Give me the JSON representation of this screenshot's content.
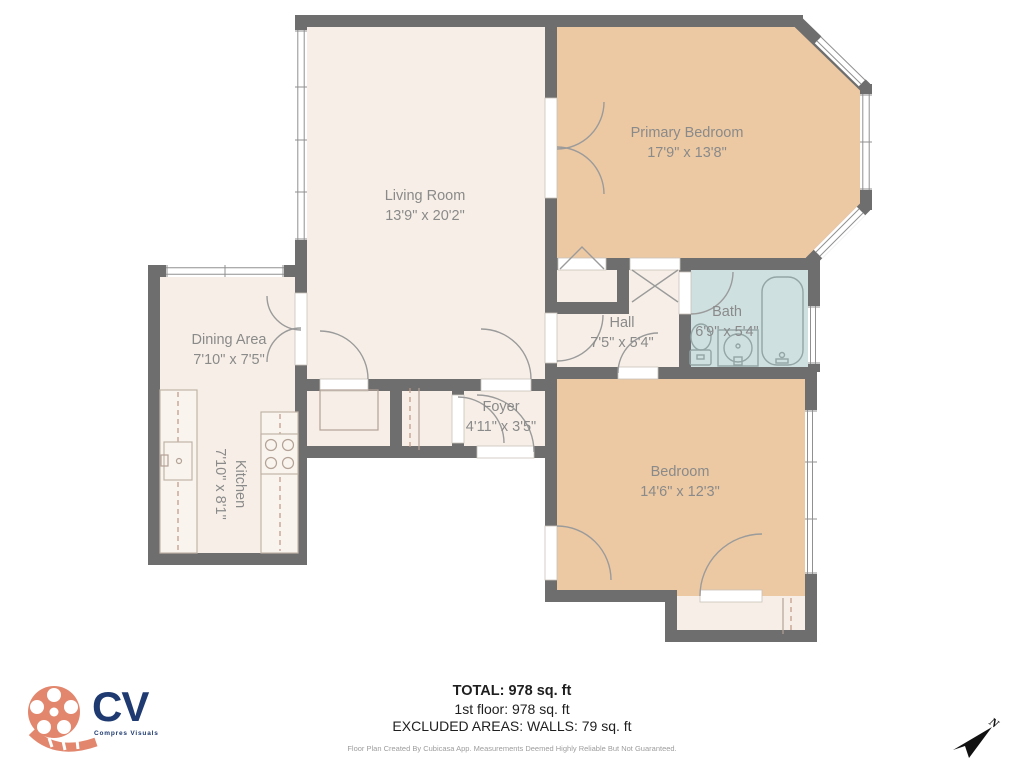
{
  "rooms": {
    "living_room": {
      "name": "Living Room",
      "dims": "13'9\" x 20'2\""
    },
    "primary_bedroom": {
      "name": "Primary Bedroom",
      "dims": "17'9\" x 13'8\""
    },
    "dining_area": {
      "name": "Dining Area",
      "dims": "7'10\" x 7'5\""
    },
    "kitchen": {
      "name": "Kitchen",
      "dims": "7'10\" x 8'1\""
    },
    "hall": {
      "name": "Hall",
      "dims": "7'5\" x 5'4\""
    },
    "bath": {
      "name": "Bath",
      "dims": "6'9\" x 5'4\""
    },
    "foyer": {
      "name": "Foyer",
      "dims": "4'11\" x 3'5\""
    },
    "bedroom": {
      "name": "Bedroom",
      "dims": "14'6\" x 12'3\""
    }
  },
  "summary": {
    "total": "TOTAL: 978 sq. ft",
    "first_floor": "1st floor: 978 sq. ft",
    "excluded": "EXCLUDED AREAS: WALLS: 79 sq. ft",
    "disclaimer": "Floor Plan Created By Cubicasa App. Measurements Deemed Highly Reliable But Not Guaranteed."
  },
  "branding": {
    "logo_text": "CV",
    "logo_subtext": "Compres Visuals"
  },
  "compass": {
    "north_label": "N"
  },
  "colors": {
    "wall": "#6e6e6e",
    "room_light": "#f7efe7",
    "room_tan": "#ecc9a3",
    "bath_blue": "#cfe0e0",
    "logo_coral": "#e2876e",
    "logo_navy": "#1e3a70"
  }
}
